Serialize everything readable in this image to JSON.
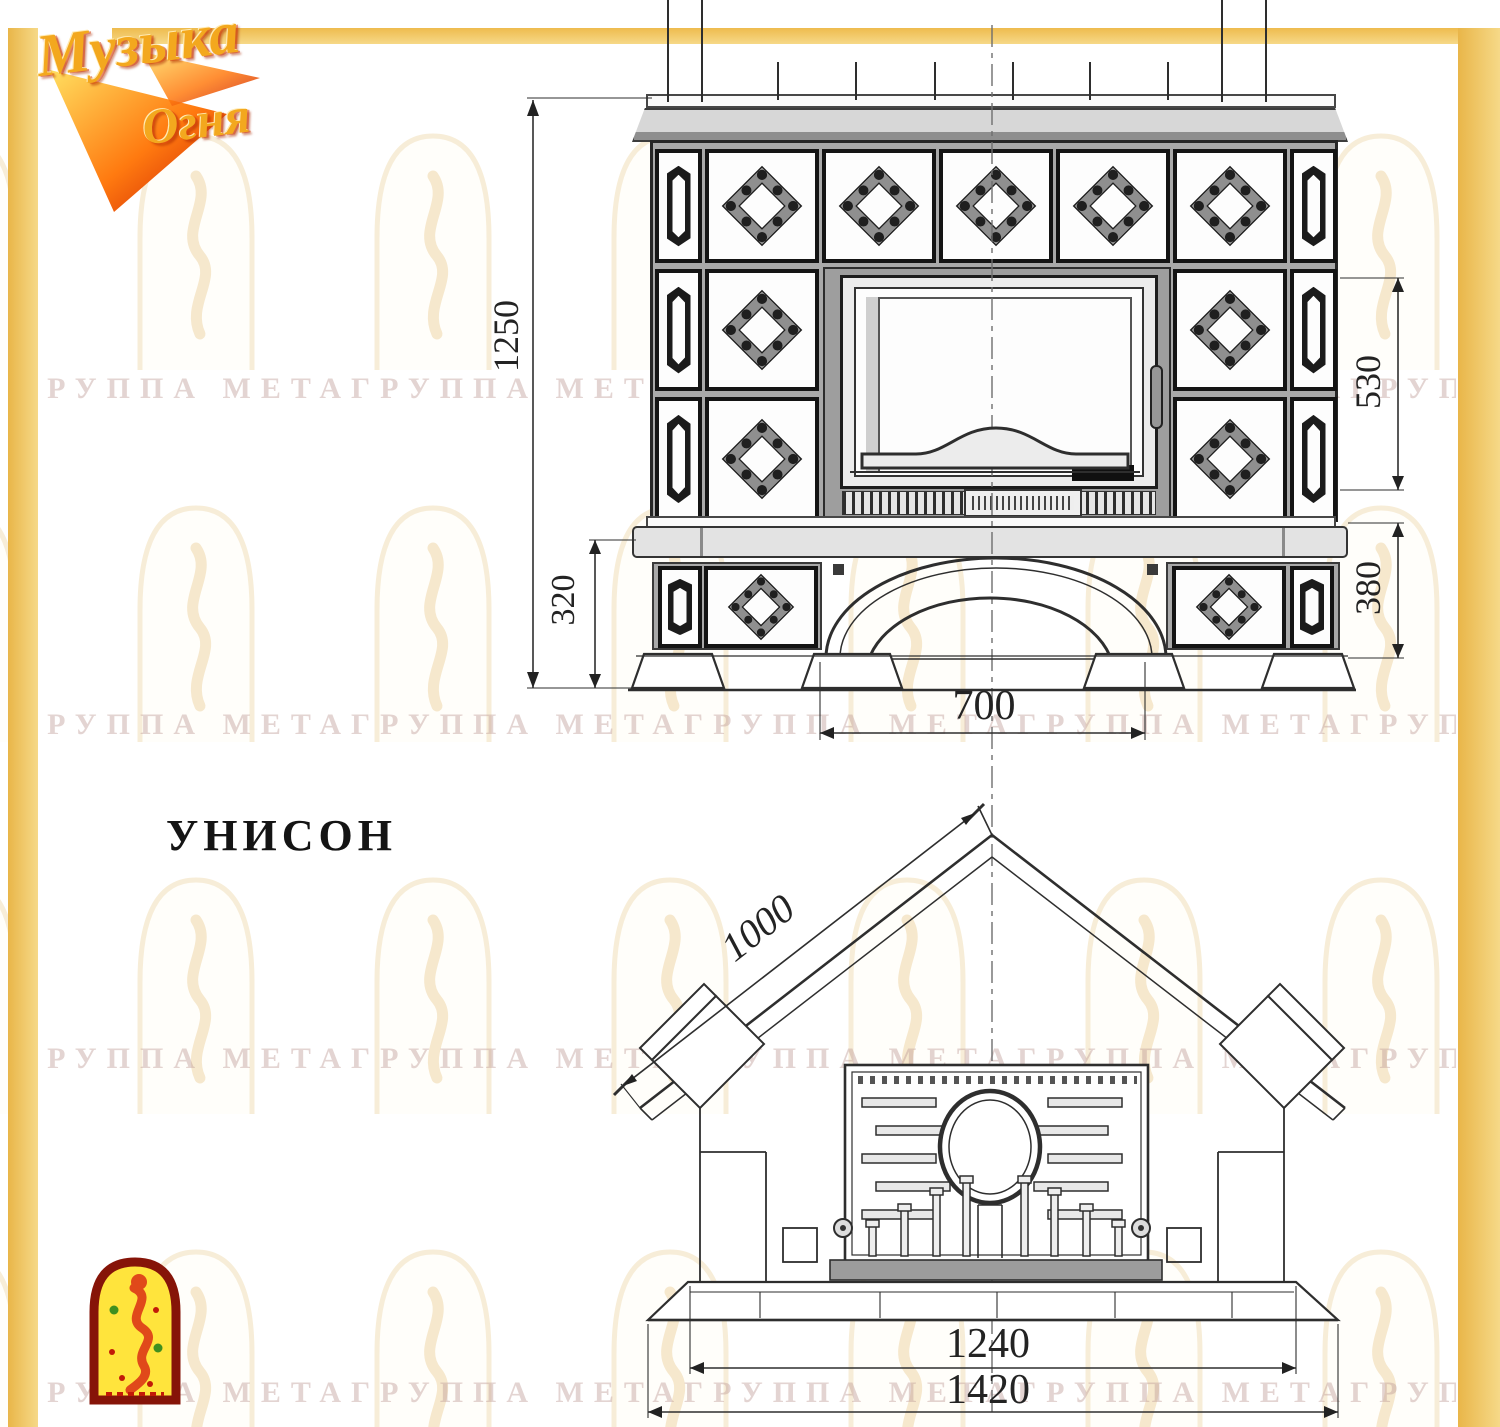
{
  "logo": {
    "line1": "Музыка",
    "line2": "Огня"
  },
  "model": {
    "title": "УНИСОН"
  },
  "watermark": {
    "text": "ГРУППА МЕТАГРУППА МЕТАГРУППА МЕТАГРУППА МЕТАГРУППА МЕТА"
  },
  "front_view": {
    "dimensions": {
      "total_height": "1250",
      "firebox_height": "530",
      "base_left_height": "320",
      "base_right_height": "380",
      "arch_width": "700"
    }
  },
  "plan_view": {
    "dimensions": {
      "side_depth": "1000",
      "inner_width": "1240",
      "overall_width": "1420"
    }
  }
}
